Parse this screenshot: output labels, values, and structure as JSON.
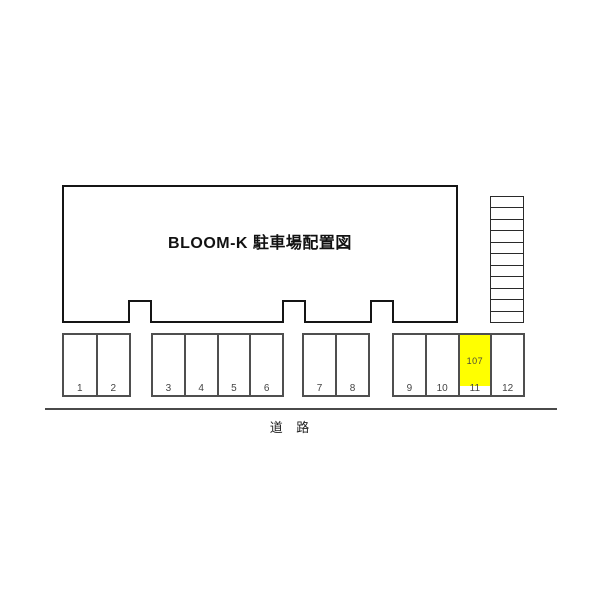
{
  "title": "BLOOM-K 駐車場配置図",
  "road": {
    "label": "道 路"
  },
  "staircase": {
    "steps": 11
  },
  "parking": {
    "groups": [
      {
        "spaces": [
          "1",
          "2"
        ]
      },
      {
        "spaces": [
          "3",
          "4",
          "5",
          "6"
        ]
      },
      {
        "spaces": [
          "7",
          "8"
        ]
      },
      {
        "spaces": [
          "9",
          "10",
          "11",
          "12"
        ]
      }
    ],
    "highlight": {
      "space": "11",
      "unit_label": "107",
      "color": "#ffff00"
    }
  },
  "colors": {
    "building_border": "#151515",
    "parking_border": "#4f4f4f",
    "road_line": "#4a4a4a"
  }
}
